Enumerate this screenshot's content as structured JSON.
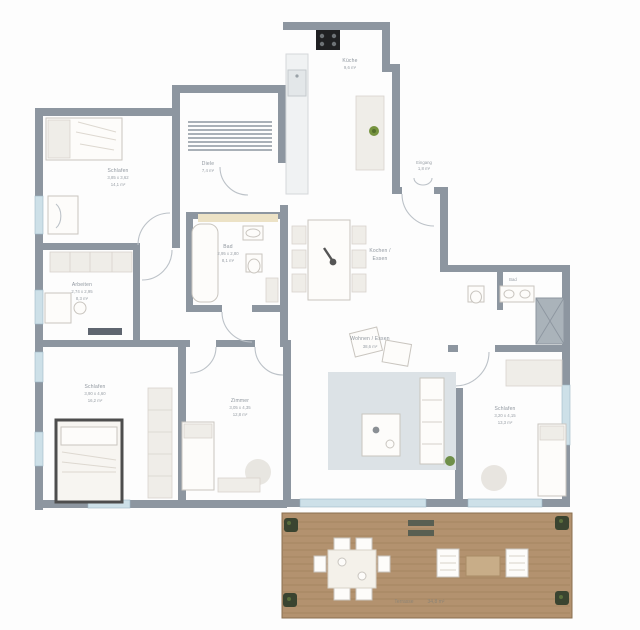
{
  "plan": {
    "type": "apartment-floor-plan",
    "rooms": {
      "bedroom1": {
        "name": "Schlafen",
        "dims": "3,85 x 3,62",
        "area": "14,1 m²"
      },
      "study": {
        "name": "Arbeiten",
        "dims": "2,74 x 2,95",
        "area": "8,3 m²"
      },
      "bedroom2": {
        "name": "Schlafen",
        "dims": "3,90 x 4,60",
        "area": "16,2 m²"
      },
      "bath": {
        "name": "Bad",
        "dims": "2,95 x 2,80",
        "area": "8,1 m²"
      },
      "child": {
        "name": "Zimmer",
        "dims": "3,05 x 4,35",
        "area": "12,8 m²"
      },
      "living": {
        "name": "Wohnen / Essen",
        "area": "38,6 m²"
      },
      "cooking": {
        "name": "Kochen /",
        "name2": "Essen"
      },
      "kitchen": {
        "name": "Küche",
        "area": "9,6 m²"
      },
      "hall": {
        "name": "Diele",
        "area": "7,4 m²"
      },
      "entrance": {
        "name": "Eingang",
        "area": "1,8 m²"
      },
      "bath2": {
        "name": "Bad",
        "area": "4,9 m²"
      },
      "bedroom3": {
        "name": "Schlafen",
        "dims": "3,20 x 4,15",
        "area": "13,3 m²"
      },
      "terrace": {
        "name": "Terrasse",
        "area": "34,8 m²"
      }
    },
    "colors": {
      "wall": "#8d96a0",
      "window": "#cde0e8",
      "deck": "#b3926f",
      "plant": "#3a4430",
      "rug": "#dce2e6",
      "bed_frame_dark": "#4d4d4d",
      "stove": "#1f2022"
    }
  }
}
